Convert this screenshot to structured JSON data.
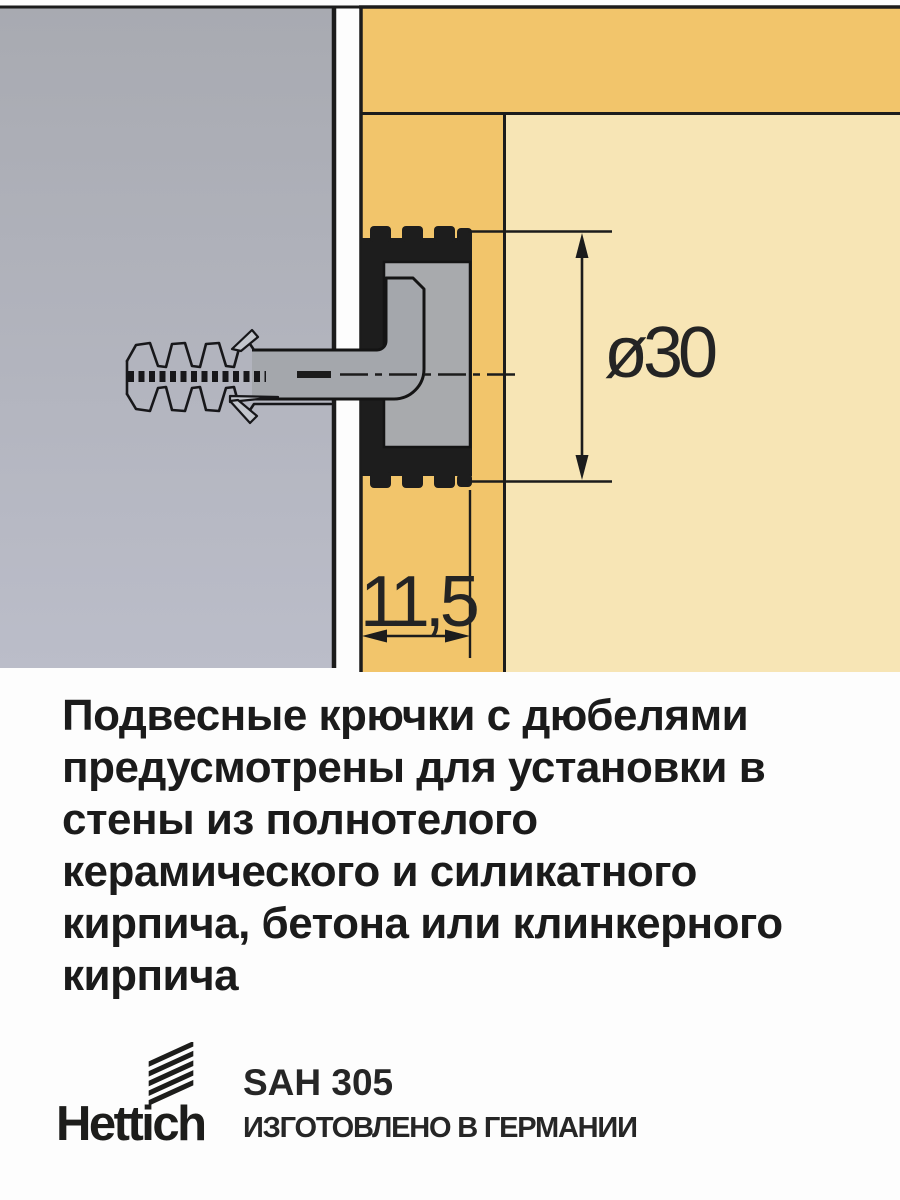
{
  "diagram": {
    "dim_diameter": "ø30",
    "dim_depth": "11,5",
    "colors": {
      "wall_gray": "#aeb0ba",
      "panel_yellow": "#f2c56b",
      "panel_light": "#f7e5b5",
      "sleeve_black": "#1d1d1d",
      "metal_gray": "#a8aaad",
      "line_black": "#1c1c1c",
      "text_black": "#1b1b1b"
    }
  },
  "description": "Подвесные крючки с дюбелями\nпредусмотрены для установки в\nстены из полнотелого\nкерамического и силикатного\nкирпича, бетона или клинкерного\nкирпича",
  "footer": {
    "brand": "Hettich",
    "model": "SAH 305",
    "origin": "ИЗГОТОВЛЕНО В ГЕРМАНИИ"
  }
}
